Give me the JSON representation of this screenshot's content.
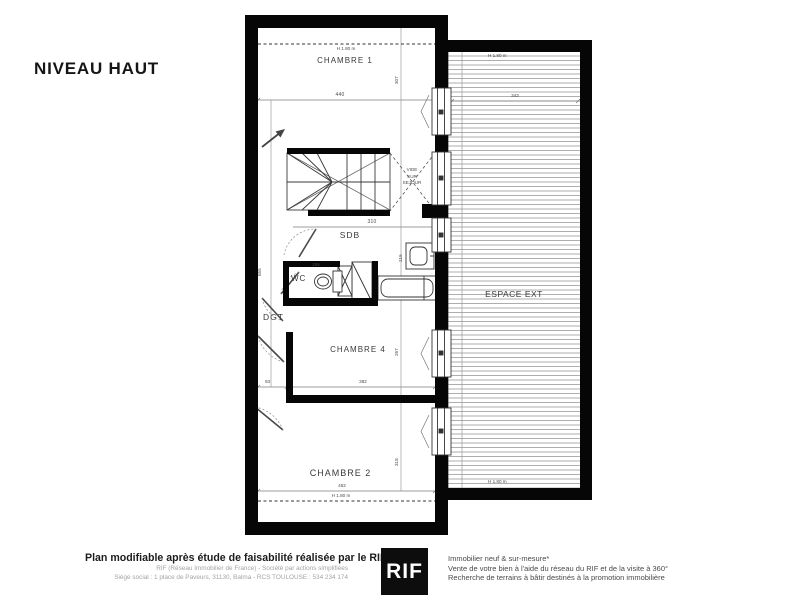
{
  "page": {
    "title": "NIVEAU HAUT"
  },
  "plan": {
    "chambre1": {
      "name": "CHAMBRE 1",
      "height_line": "H 1.80 m",
      "width": "440",
      "depth": "307"
    },
    "vide": {
      "line1": "VIDE",
      "line2": "SUR",
      "line3": "SEJOUR"
    },
    "sdb": {
      "name": "SDB",
      "width": "310",
      "depth": "215"
    },
    "wc": {
      "name": "WC",
      "width": "155"
    },
    "dgt": {
      "name": "DGT"
    },
    "chambre4": {
      "name": "CHAMBRE 4",
      "offset": "93",
      "width": "382",
      "depth": "267"
    },
    "chambre2": {
      "name": "CHAMBRE 2",
      "width": "462",
      "height_line": "H 1.80 m",
      "depth": "318"
    },
    "espace_ext": {
      "name": "ESPACE EXT",
      "width": "343",
      "height_line_top": "H 1.80 m",
      "height_line_bottom": "H 1.80 m"
    },
    "overall_depth": "655"
  },
  "footer": {
    "headline": "Plan modifiable après étude de faisabilité réalisée par le RIF",
    "company_line": "RIF (Réseau Immobilier de France) - Société par actions simplifiées",
    "address_line": "Siège social : 1 place de Paveurs, 31130, Balma - RCS TOULOUSE : 534 234 174",
    "logo": "RIF",
    "services": [
      "Immobilier neuf & sur-mesure*",
      "Vente de votre bien à l'aide du réseau du RIF et de la visite à 360°",
      "Recherche de terrains à bâtir destinés à la promotion immobilière"
    ]
  }
}
